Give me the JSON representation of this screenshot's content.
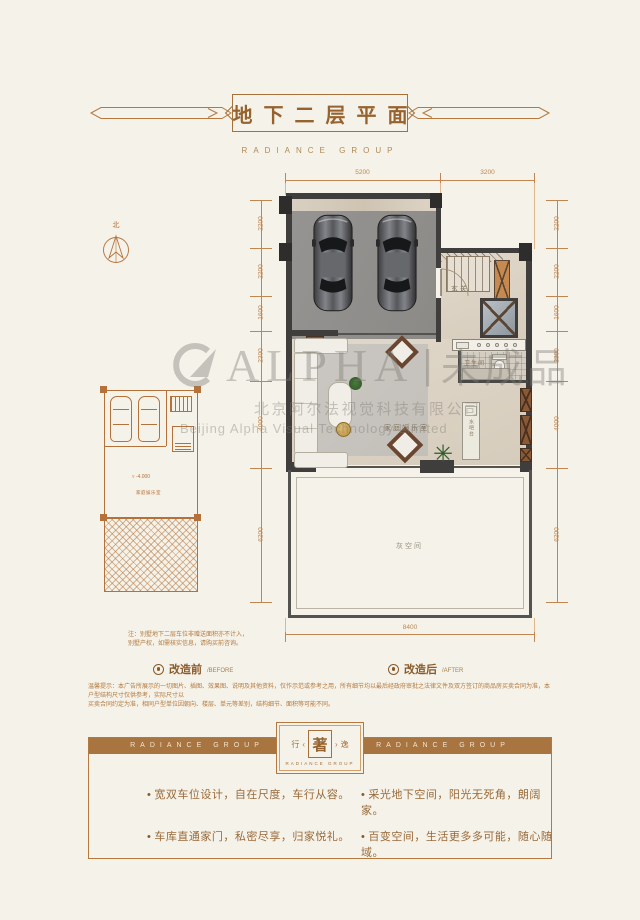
{
  "header": {
    "title": "地下二层平面",
    "brand": "RADIANCE GROUP"
  },
  "compass": {
    "north": "北"
  },
  "plan": {
    "dims_top": [
      "5200",
      "3200"
    ],
    "dims_left": [
      "2200",
      "2200",
      "1600",
      "2300",
      "4000",
      "6200"
    ],
    "dims_right": [
      "2200",
      "2200",
      "1600",
      "2300",
      "4000",
      "6200"
    ],
    "dim_bottom": "8400",
    "labels": {
      "entry": "玄关",
      "bathroom": "卫生间",
      "family_room": "家庭娱乐室",
      "water_bar": "水吧台",
      "gray_space": "灰空间"
    }
  },
  "before_plan": {
    "level_mark": "-4.000",
    "room_label": "家庭娱乐室"
  },
  "note": {
    "line1": "注：别墅地下二层车位非赠送面积亦不计入，",
    "line2": "别墅产权，如需核实信息，请购买前咨询。"
  },
  "legend": {
    "before_cn": "改造前",
    "before_en": "/BEFORE",
    "after_cn": "改造后",
    "after_en": "/AFTER"
  },
  "disclaimer": {
    "line1": "温馨提示：本广告所展示的一切图片、插图、效果图、说明及其他资料，仅作示范或参考之用，所有细节均以最后经政府审批之法律文件及双方签订的商品房买卖合同为准，本户型结构尺寸仅供参考，实际尺寸以",
    "line2": "买卖合同约定为准，相同户型单位因朝向、楼层、单元等差别，结构细节、面积等可能不同。"
  },
  "watermark": {
    "brand": "ALPHA",
    "divider": "|",
    "stamp": "未成品",
    "company_cn": "北京阿尔法视觉科技有限公司",
    "company_en": "Beijing Alpha  Visual Technology Limited"
  },
  "footer": {
    "brand_left": "RADIANCE GROUP",
    "brand_right": "RADIANCE GROUP",
    "badge": {
      "left": "行",
      "center": "著",
      "right": "逸",
      "sub": "RADIANCE GROUP"
    },
    "bullets": [
      "宽双车位设计，自在尺度，车行从容。",
      "车库直通家门，私密尽享，归家悦礼。",
      "采光地下空间，阳光无死角，朗阔家。",
      "百变空间，生活更多多可能，随心随域。"
    ]
  }
}
